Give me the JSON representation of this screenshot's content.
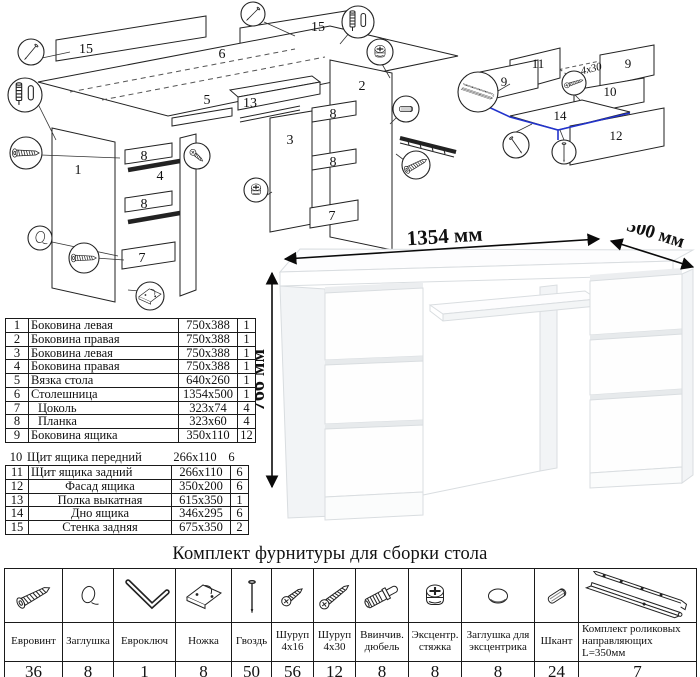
{
  "colors": {
    "line": "#1a1a1a",
    "highlight_blue": "#2233cc",
    "desk_edge": "#d9dde0",
    "desk_side": "#f2f4f6"
  },
  "main_diagram": {
    "labels": {
      "p15a": "15",
      "p15b": "15",
      "p6": "6",
      "p5": "5",
      "p13": "13",
      "p1": "1",
      "p2": "2",
      "p3": "3",
      "p4": "4",
      "p8a": "8",
      "p8b": "8",
      "p8c": "8",
      "p8d": "8",
      "p7a": "7",
      "p7b": "7"
    },
    "callout_icons": [
      "nail",
      "screwin-dowel-with-cap",
      "euroscrew",
      "cap",
      "leg",
      "eccentric-cam",
      "dowel",
      "screw"
    ]
  },
  "drawer_diagram": {
    "labels": {
      "p11": "11",
      "p9a": "9",
      "p9b": "9",
      "p10": "10",
      "p14": "14",
      "p12": "12"
    },
    "screw_note": "4x30"
  },
  "desk": {
    "width_label": "1354 мм",
    "depth_label": "500 мм",
    "height_label": "766 мм"
  },
  "parts_table": {
    "rows": [
      {
        "num": "1",
        "name": "Боковина левая",
        "size": "750x388",
        "qty": "1"
      },
      {
        "num": "2",
        "name": "Боковина правая",
        "size": "750x388",
        "qty": "1"
      },
      {
        "num": "3",
        "name": "Боковина левая",
        "size": "750x388",
        "qty": "1"
      },
      {
        "num": "4",
        "name": "Боковина правая",
        "size": "750x388",
        "qty": "1"
      },
      {
        "num": "5",
        "name": "Вязка стола",
        "size": "640x260",
        "qty": "1"
      },
      {
        "num": "6",
        "name": "Столешница",
        "size": "1354x500",
        "qty": "1"
      },
      {
        "num": "7",
        "name": "Цоколь",
        "size": "323x74",
        "qty": "4"
      },
      {
        "num": "8",
        "name": "Планка",
        "size": "323x60",
        "qty": "4"
      },
      {
        "num": "9",
        "name": "Боковина ящика",
        "size": "350x110",
        "qty": "12"
      },
      {
        "num": "10",
        "name": "Щит ящика передний",
        "size": "266x110",
        "qty": "6"
      },
      {
        "num": "11",
        "name": "Щит ящика задний",
        "size": "266x110",
        "qty": "6"
      },
      {
        "num": "12",
        "name": "Фасад ящика",
        "size": "350x200",
        "qty": "6"
      },
      {
        "num": "13",
        "name": "Полка выкатная",
        "size": "615x350",
        "qty": "1"
      },
      {
        "num": "14",
        "name": "Дно ящика",
        "size": "346x295",
        "qty": "6"
      },
      {
        "num": "15",
        "name": "Стенка задняя",
        "size": "675x350",
        "qty": "2"
      }
    ]
  },
  "hardware": {
    "title": "Комплект фурнитуры для сборки стола",
    "items": [
      {
        "name": "Евровинт",
        "qty": "36",
        "icon": "euroscrew"
      },
      {
        "name": "Заглушка",
        "qty": "8",
        "icon": "cap"
      },
      {
        "name": "Евроключ",
        "qty": "1",
        "icon": "hex-key"
      },
      {
        "name": "Ножка",
        "qty": "8",
        "icon": "leg"
      },
      {
        "name": "Гвоздь",
        "qty": "50",
        "icon": "nail"
      },
      {
        "name": "Шуруп 4x16",
        "qty": "56",
        "icon": "screw-small"
      },
      {
        "name": "Шуруп 4x30",
        "qty": "12",
        "icon": "screw-long"
      },
      {
        "name": "Ввинчив. дюбель",
        "qty": "8",
        "icon": "screwin-dowel"
      },
      {
        "name": "Эксцентр. стяжка",
        "qty": "8",
        "icon": "eccentric-cam"
      },
      {
        "name": "Заглушка для эксцентрика",
        "qty": "8",
        "icon": "cam-cap"
      },
      {
        "name": "Шкант",
        "qty": "24",
        "icon": "dowel"
      },
      {
        "name": "Комплект роликовых направляющих L=350мм",
        "qty": "7",
        "icon": "roller-guides"
      }
    ]
  }
}
